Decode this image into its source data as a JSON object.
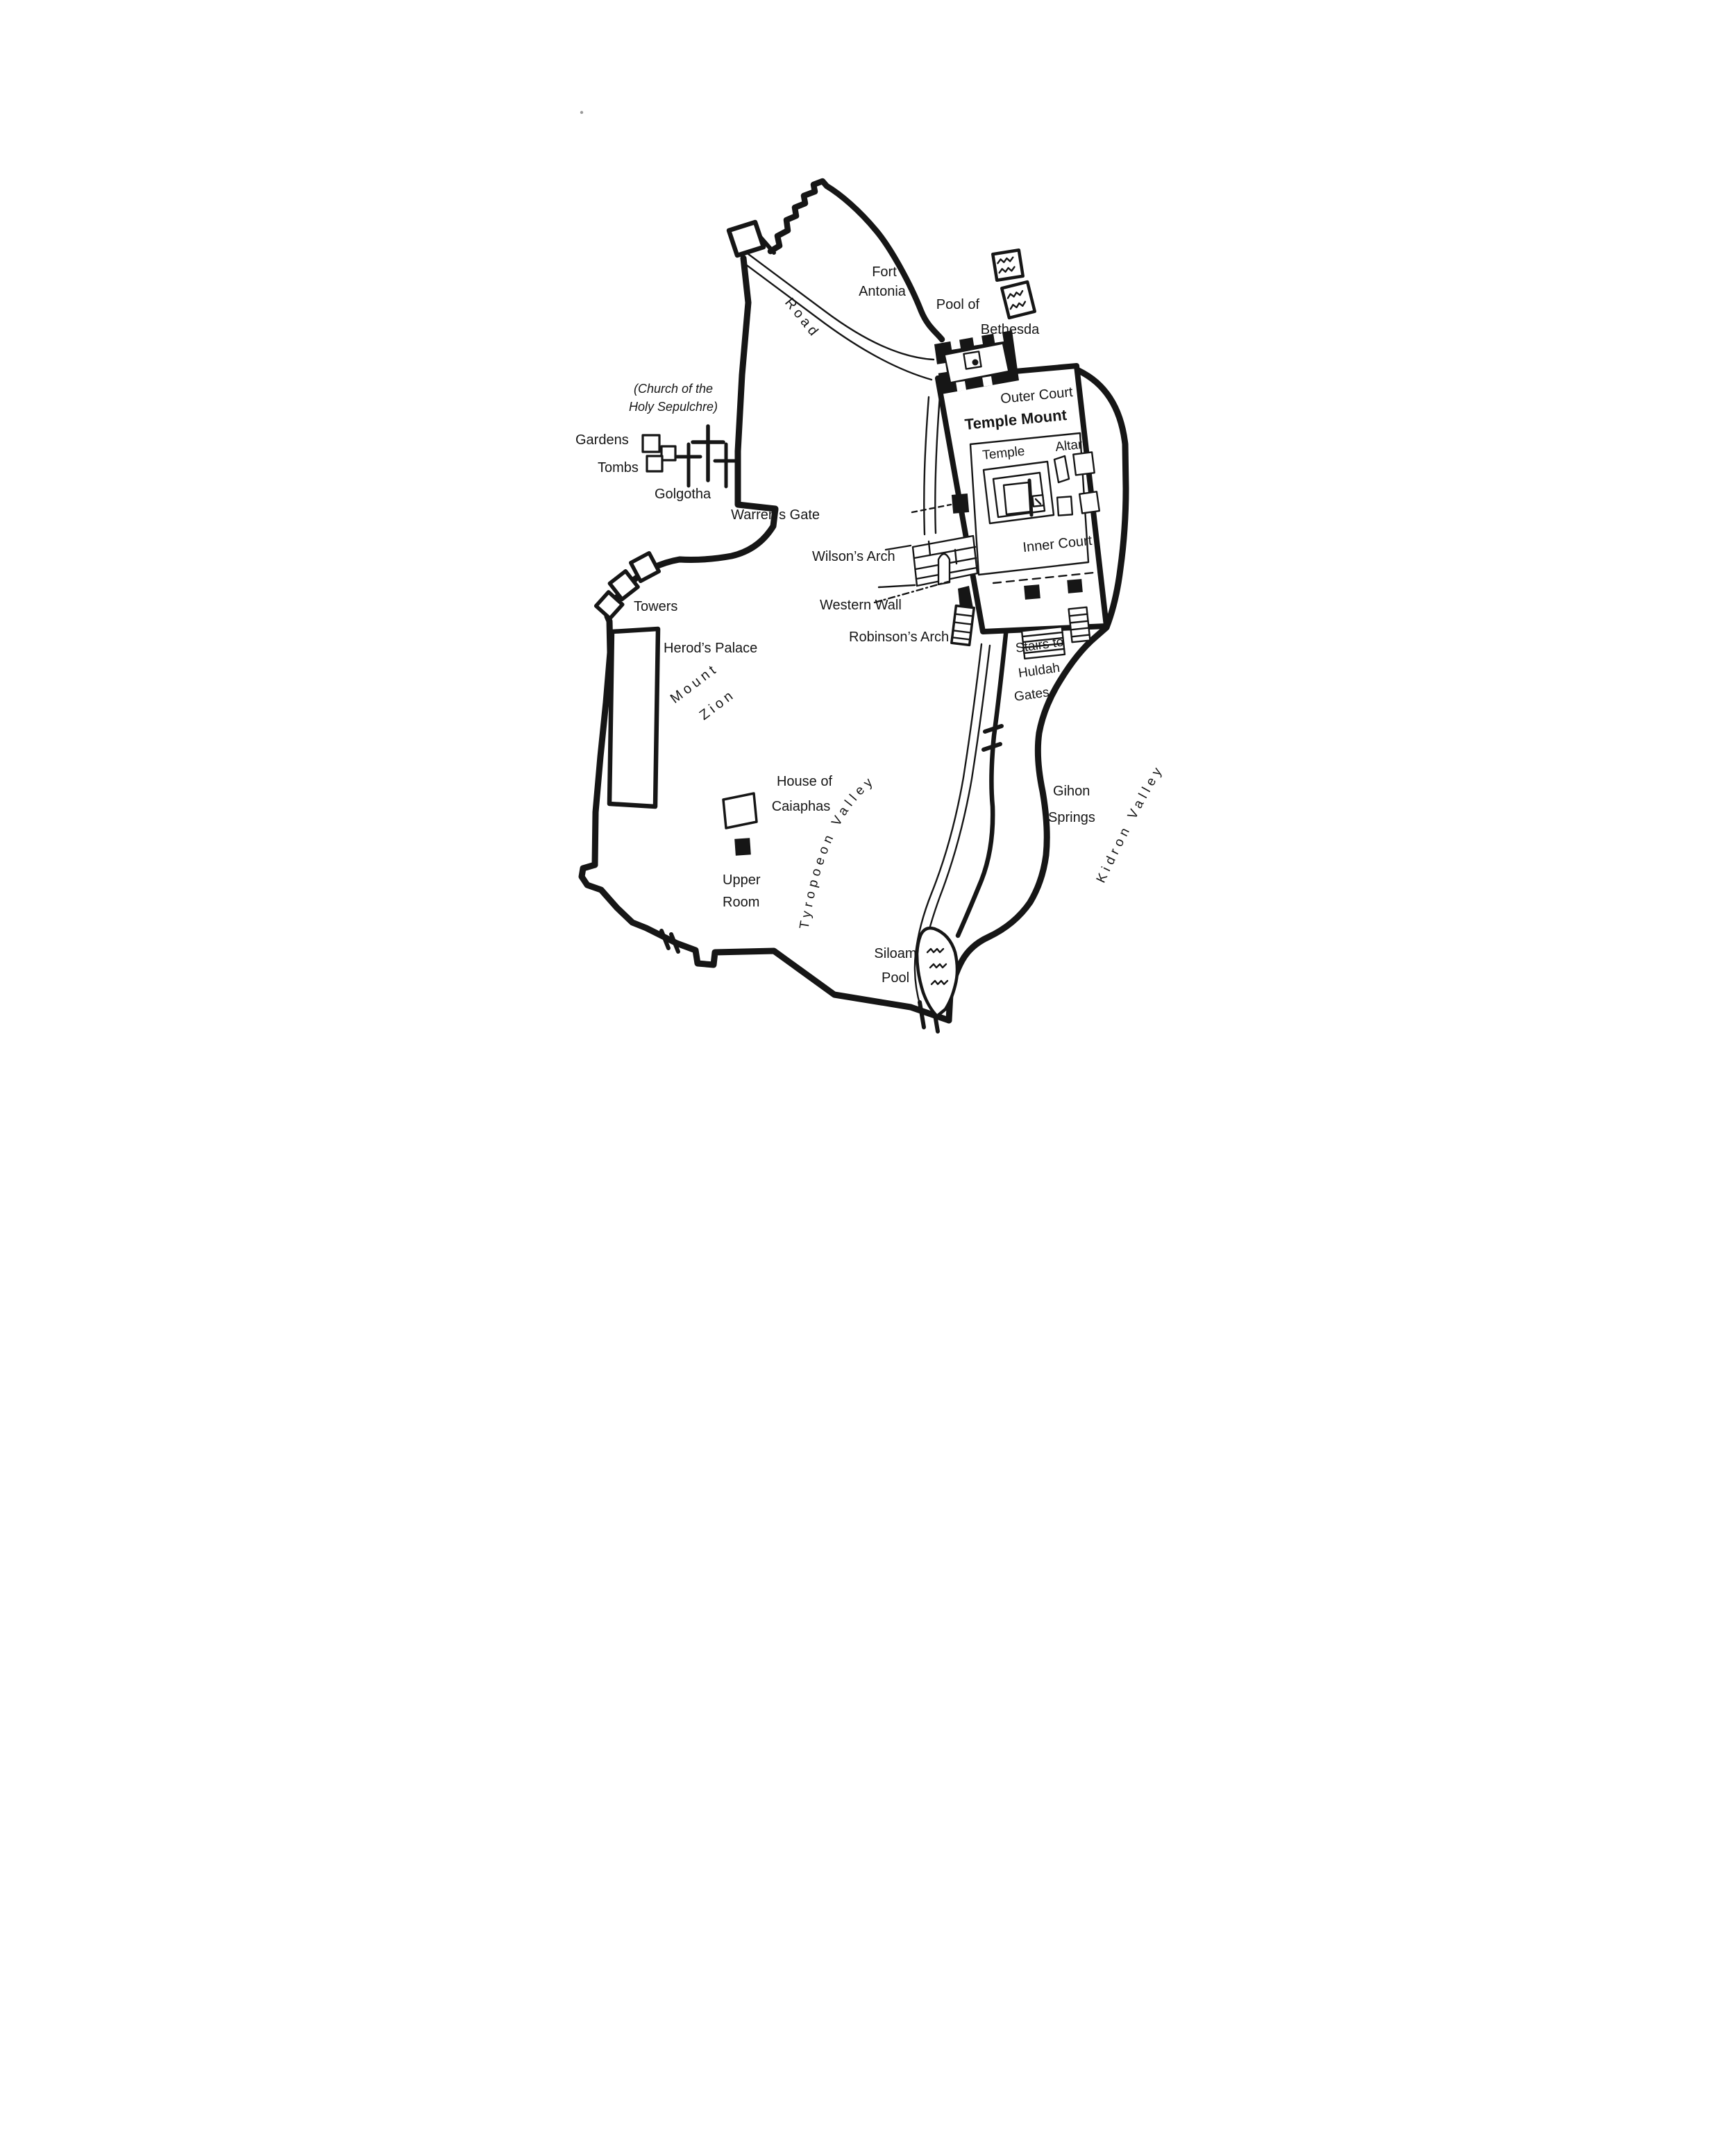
{
  "map": {
    "region_labels": {
      "fort_antonia_line1": "Fort",
      "fort_antonia_line2": "Antonia",
      "pool_bethesda_line1": "Pool of",
      "pool_bethesda_line2": "Bethesda",
      "church_note_line1": "(Church of the",
      "church_note_line2": "Holy Sepulchre)",
      "gardens": "Gardens",
      "tombs": "Tombs",
      "golgotha": "Golgotha",
      "road": "Road",
      "outer_court": "Outer Court",
      "temple_mount": "Temple Mount",
      "temple": "Temple",
      "altar": "Altar",
      "inner_court": "Inner Court",
      "warrens_gate": "Warren’s Gate",
      "wilsons_arch": "Wilson’s Arch",
      "western_wall": "Western Wall",
      "robinsons_arch": "Robinson’s Arch",
      "stairs_line1": "Stairs to",
      "stairs_line2": "Huldah",
      "stairs_line3": "Gates",
      "towers": "Towers",
      "herods_palace": "Herod’s Palace",
      "mount_zion_line1": "Mount",
      "mount_zion_line2": "Zion",
      "house_caiaphas_line1": "House of",
      "house_caiaphas_line2": "Caiaphas",
      "upper_room_line1": "Upper",
      "upper_room_line2": "Room",
      "tyropoeon_valley": "Tyropoeon Valley",
      "kidron_valley": "Kidron Valley",
      "gihon_line1": "Gihon",
      "gihon_line2": "Springs",
      "siloam_line1": "Siloam",
      "siloam_line2": "Pool"
    },
    "symbols": {
      "water_icon": "wavy water lines",
      "tomb_icon": "open square",
      "upper_room_icon": "filled black square",
      "tower_icon": "open square on wall",
      "cross_icon": "latin cross",
      "stairs_icon": "hatched steps",
      "gate_icon": "tick mark across wall"
    },
    "colors": {
      "ink": "#161616",
      "background": "#ffffff"
    }
  }
}
